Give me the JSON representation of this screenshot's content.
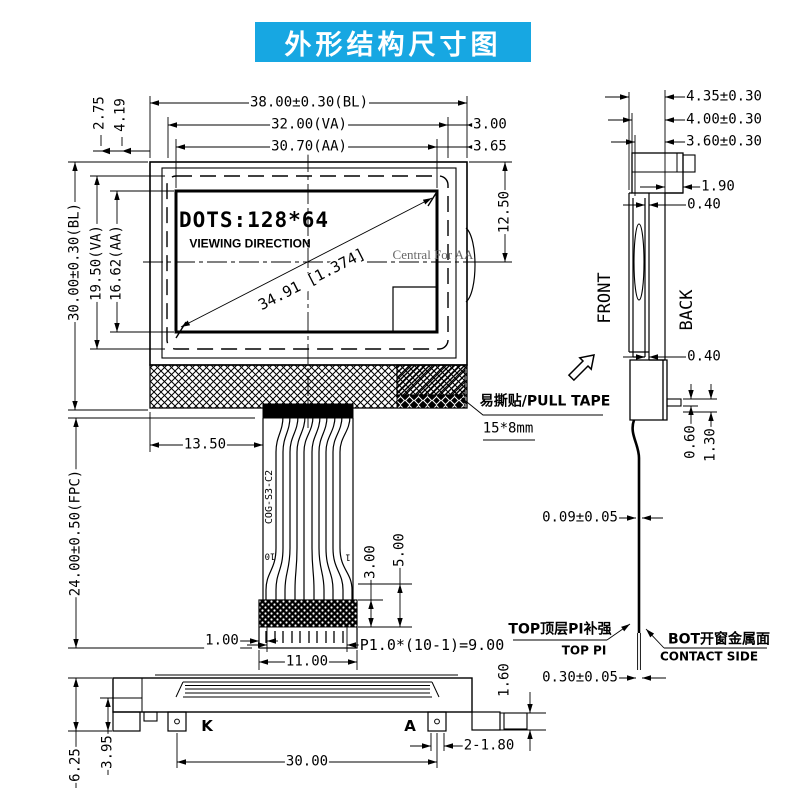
{
  "title": "外形结构尺寸图",
  "colors": {
    "accent": "#17a7e2",
    "line": "#000000",
    "muted": "#666666"
  },
  "front_view": {
    "dims": {
      "width_bl": "38.00±0.30(BL)",
      "width_va": "32.00(VA)",
      "width_aa": "30.70(AA)",
      "margin_right_va": "3.00",
      "margin_right_aa": "3.65",
      "offset_left_1": "2.75",
      "offset_left_2": "4.19",
      "height_bl": "30.00±0.30(BL)",
      "height_va": "19.50(VA)",
      "height_aa": "16.62(AA)",
      "center_offset": "12.50",
      "fpc_offset": "13.50",
      "fpc_length": "24.00±0.50(FPC)",
      "diagonal": "34.91 [1.374]"
    },
    "screen": {
      "dots": "DOTS:128*64",
      "viewing_direction": "VIEWING DIRECTION",
      "central_note": "Central For AA"
    },
    "pull_tape": {
      "label": "易撕贴/PULL TAPE",
      "size": "15*8mm"
    },
    "fpc": {
      "marking": "COG-S3-C2",
      "pin_first": "10",
      "pin_last": "1",
      "contact_len": "3.00",
      "stiffener_len": "5.00",
      "edge_margin": "1.00",
      "connector_width": "11.00",
      "pitch": "P1.0*(10-1)=9.00"
    }
  },
  "side_view": {
    "dims": {
      "t_total": "4.35±0.30",
      "t_mid": "4.00±0.30",
      "t_glass": "3.60±0.30",
      "step": "1.90",
      "gap_top": "0.40",
      "gap_bottom": "0.40",
      "pin_t": "0.60",
      "pin_w": "1.30",
      "fpc_t": "0.09±0.05",
      "contact_t": "0.30±0.05"
    },
    "labels": {
      "front": "FRONT",
      "back": "BACK",
      "top_pi_cn": "TOP顶层PI补强",
      "top_pi_en": "TOP PI",
      "bot_cn": "BOT开窗金属面",
      "bot_en": "CONTACT SIDE"
    }
  },
  "bottom_view": {
    "dims": {
      "tab_h": "1.60",
      "total_h": "6.25",
      "boss_h": "3.95",
      "hole": "2-1.80",
      "hole_span": "30.00"
    },
    "labels": {
      "cathode": "K",
      "anode": "A"
    }
  }
}
